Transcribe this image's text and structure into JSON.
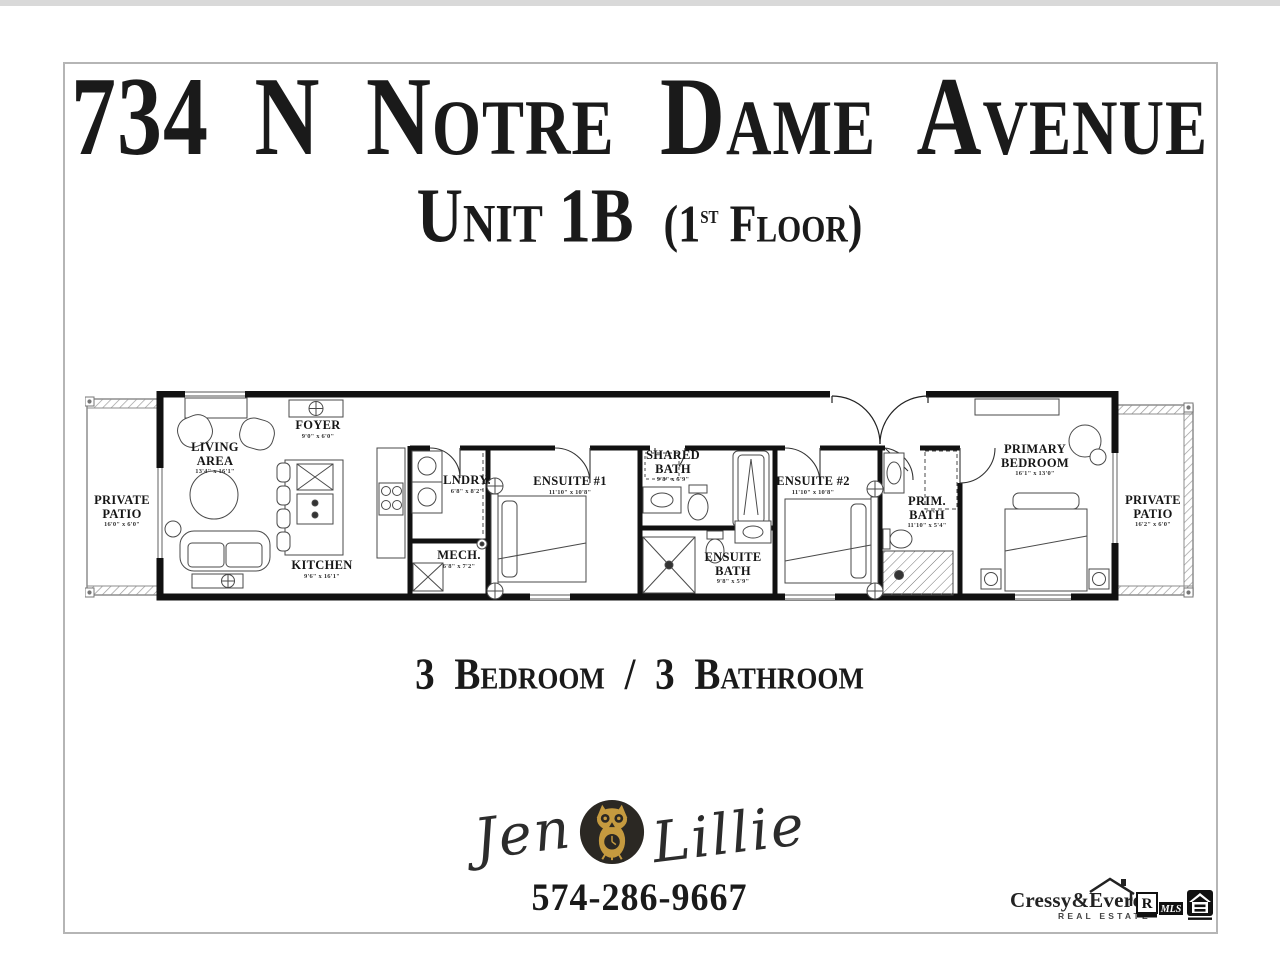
{
  "header": {
    "address": "734 N Notre Dame Avenue",
    "unit": "Unit 1B",
    "floor_prefix": "(1",
    "floor_ordinal": "st",
    "floor_suffix": " Floor)"
  },
  "summary": "3 Bedroom / 3 Bathroom",
  "agent": {
    "first_name": "Jen",
    "last_name": "Lillie",
    "phone": "574-286-9667",
    "owl_icon": "owl-logo",
    "owl_color": "#c59a3f",
    "badge_color": "#2b2823"
  },
  "brokerage": {
    "name": "Cressy&Everett",
    "tagline": "REAL ESTATE",
    "realtor_r": "R",
    "mls": "MLS"
  },
  "floor_plan": {
    "wall_color": "#111111",
    "patio_line_color": "#8d8d8d",
    "rooms": [
      {
        "name": "PRIVATE PATIO",
        "dims": "16'0\" x 6'0\""
      },
      {
        "name": "LIVING AREA",
        "dims": "13'4\" x 16'1\""
      },
      {
        "name": "FOYER",
        "dims": "9'0\" x 6'0\""
      },
      {
        "name": "KITCHEN",
        "dims": "9'6\" x 16'1\""
      },
      {
        "name": "LNDRY.",
        "dims": "6'8\" x 8'2\""
      },
      {
        "name": "MECH.",
        "dims": "6'8\" x 7'2\""
      },
      {
        "name": "ENSUITE #1",
        "dims": "11'10\" x 10'8\""
      },
      {
        "name": "SHARED BATH",
        "dims": "9'8\" x 5'9\""
      },
      {
        "name": "ENSUITE BATH",
        "dims": "9'8\" x 5'9\""
      },
      {
        "name": "ENSUITE #2",
        "dims": "11'10\" x 10'8\""
      },
      {
        "name": "PRIM. BATH",
        "dims": "11'10\" x 5'4\""
      },
      {
        "name": "PRIMARY BEDROOM",
        "dims": "16'1\" x 13'0\""
      },
      {
        "name": "PRIVATE PATIO",
        "dims": "16'2\" x 6'0\""
      }
    ]
  }
}
